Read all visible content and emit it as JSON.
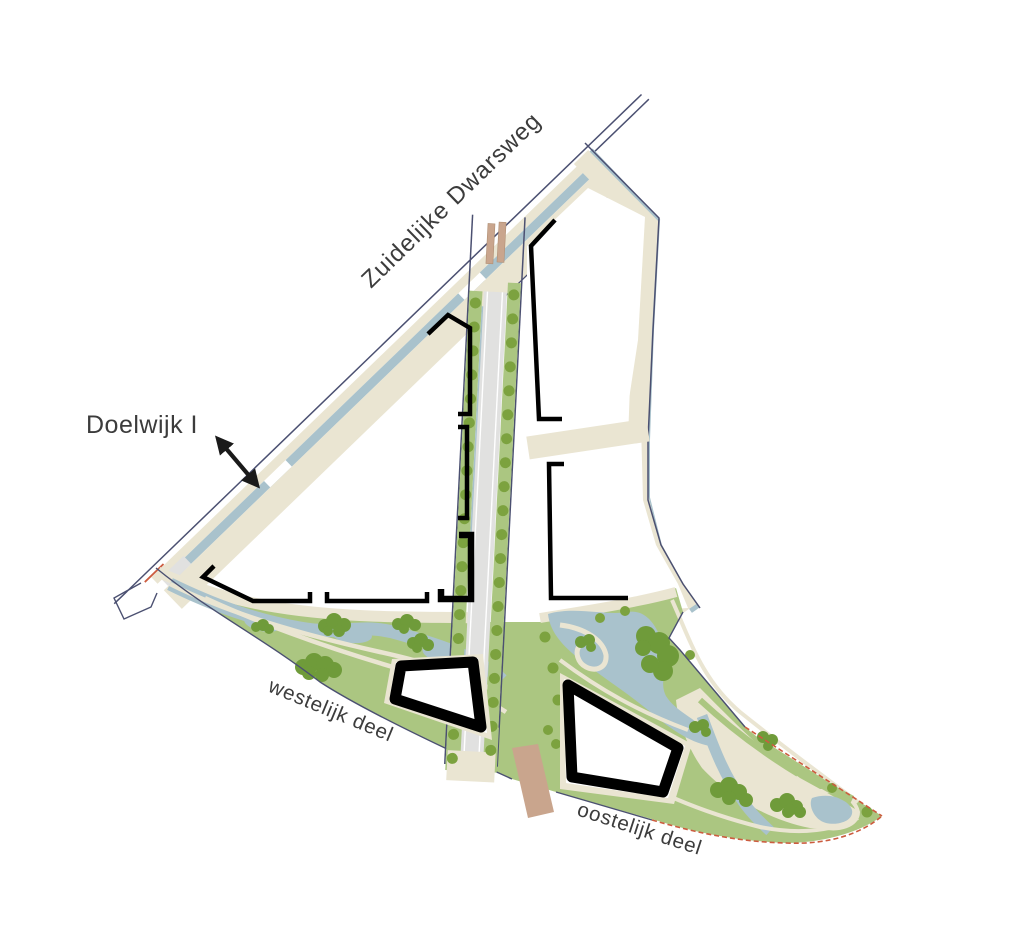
{
  "labels": {
    "road": "Zuidelijke Dwarsweg",
    "district": "Doelwijk I",
    "west": "westelijk deel",
    "east": "oostelijk deel"
  },
  "colors": {
    "background": "#ffffff",
    "road_beige": "#eae5d2",
    "water": "#a9c2cc",
    "park_green": "#abc681",
    "tree_olive": "#7ca23f",
    "tree_cluster": "#6f9b3a",
    "road_grey": "#e1e1e0",
    "lane_white": "#ffffff",
    "outline_navy": "#4b5071",
    "building_black": "#000000",
    "bridge_tan": "#c9a58d",
    "boundary_red": "#cc5c3f",
    "label_text": "#3c3c3c"
  }
}
